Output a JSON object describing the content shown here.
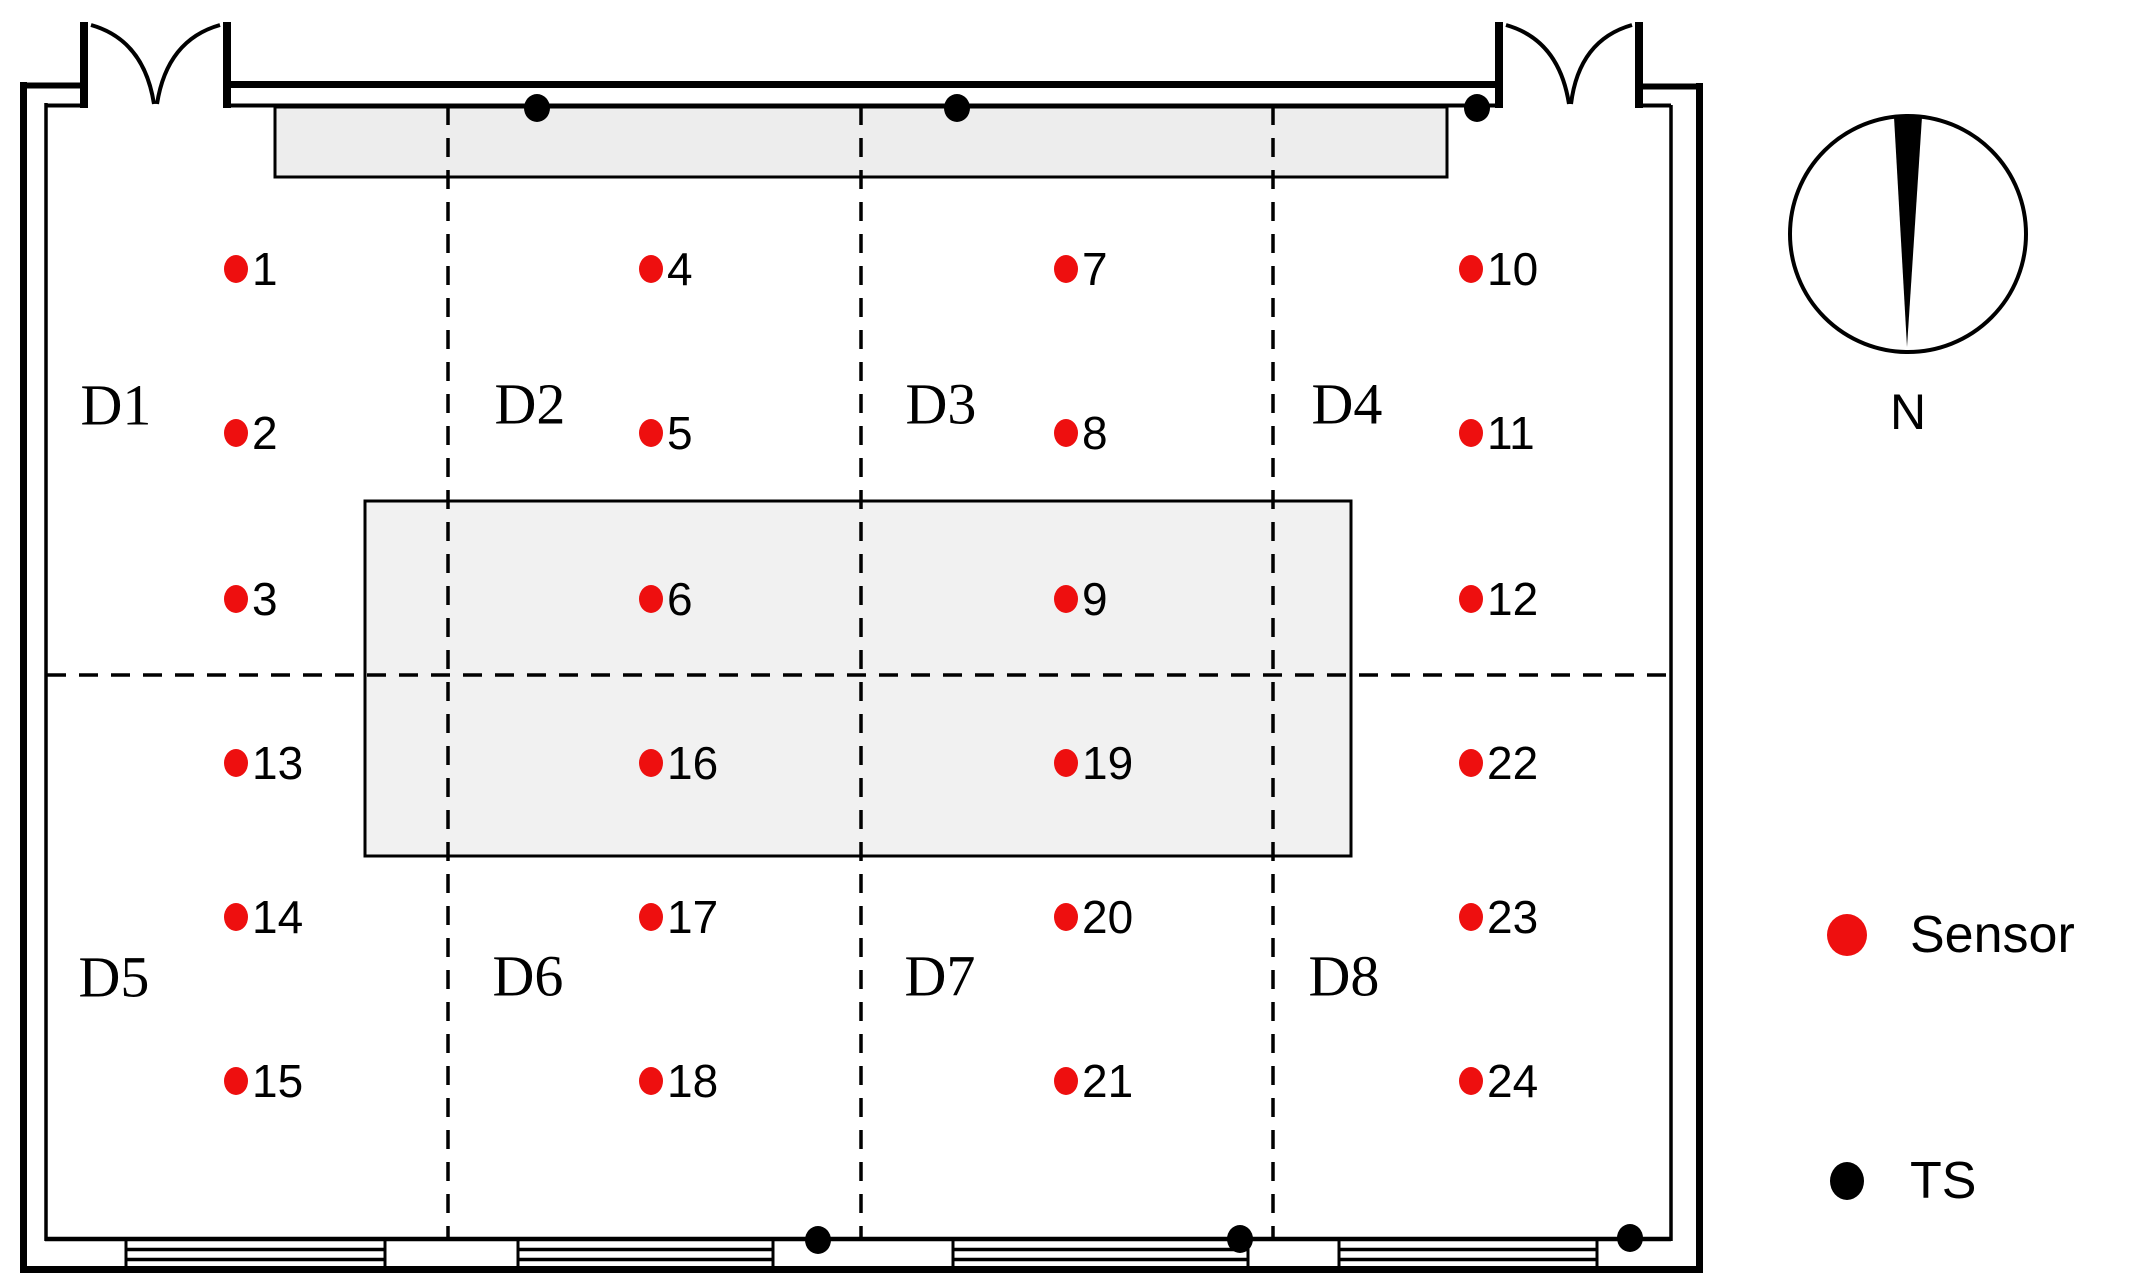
{
  "diagram": {
    "type": "floor-plan",
    "description": "Room plan with numbered sensor grid, thermal stations (TS), zones D1-D8, two double doors, bottom windows and north compass"
  },
  "compass": {
    "label": "N"
  },
  "legend": {
    "sensor_label": "Sensor",
    "ts_label": "TS"
  },
  "colors": {
    "sensor": "#ee0f0f",
    "ts": "#000000",
    "shaded_area": "#ededed",
    "wall": "#000000"
  },
  "zones": [
    {
      "label": "D1",
      "x": 116,
      "y": 405
    },
    {
      "label": "D2",
      "x": 530,
      "y": 404
    },
    {
      "label": "D3",
      "x": 941,
      "y": 404
    },
    {
      "label": "D4",
      "x": 1347,
      "y": 404
    },
    {
      "label": "D5",
      "x": 114,
      "y": 977
    },
    {
      "label": "D6",
      "x": 528,
      "y": 976
    },
    {
      "label": "D7",
      "x": 940,
      "y": 976
    },
    {
      "label": "D8",
      "x": 1344,
      "y": 976
    }
  ],
  "sensors": [
    {
      "id": "1",
      "x": 236,
      "y": 269
    },
    {
      "id": "2",
      "x": 236,
      "y": 433
    },
    {
      "id": "3",
      "x": 236,
      "y": 599
    },
    {
      "id": "13",
      "x": 236,
      "y": 763
    },
    {
      "id": "14",
      "x": 236,
      "y": 917
    },
    {
      "id": "15",
      "x": 236,
      "y": 1081
    },
    {
      "id": "4",
      "x": 651,
      "y": 269
    },
    {
      "id": "5",
      "x": 651,
      "y": 433
    },
    {
      "id": "6",
      "x": 651,
      "y": 599
    },
    {
      "id": "16",
      "x": 651,
      "y": 763
    },
    {
      "id": "17",
      "x": 651,
      "y": 917
    },
    {
      "id": "18",
      "x": 651,
      "y": 1081
    },
    {
      "id": "7",
      "x": 1066,
      "y": 269
    },
    {
      "id": "8",
      "x": 1066,
      "y": 433
    },
    {
      "id": "9",
      "x": 1066,
      "y": 599
    },
    {
      "id": "19",
      "x": 1066,
      "y": 763
    },
    {
      "id": "20",
      "x": 1066,
      "y": 917
    },
    {
      "id": "21",
      "x": 1066,
      "y": 1081
    },
    {
      "id": "10",
      "x": 1471,
      "y": 269
    },
    {
      "id": "11",
      "x": 1471,
      "y": 433
    },
    {
      "id": "12",
      "x": 1471,
      "y": 599
    },
    {
      "id": "22",
      "x": 1471,
      "y": 763
    },
    {
      "id": "23",
      "x": 1471,
      "y": 917
    },
    {
      "id": "24",
      "x": 1471,
      "y": 1081
    }
  ],
  "ts_points": [
    {
      "x": 537,
      "y": 108
    },
    {
      "x": 957,
      "y": 108
    },
    {
      "x": 1477,
      "y": 108
    },
    {
      "x": 818,
      "y": 1240
    },
    {
      "x": 1240,
      "y": 1239
    },
    {
      "x": 1630,
      "y": 1238
    }
  ]
}
